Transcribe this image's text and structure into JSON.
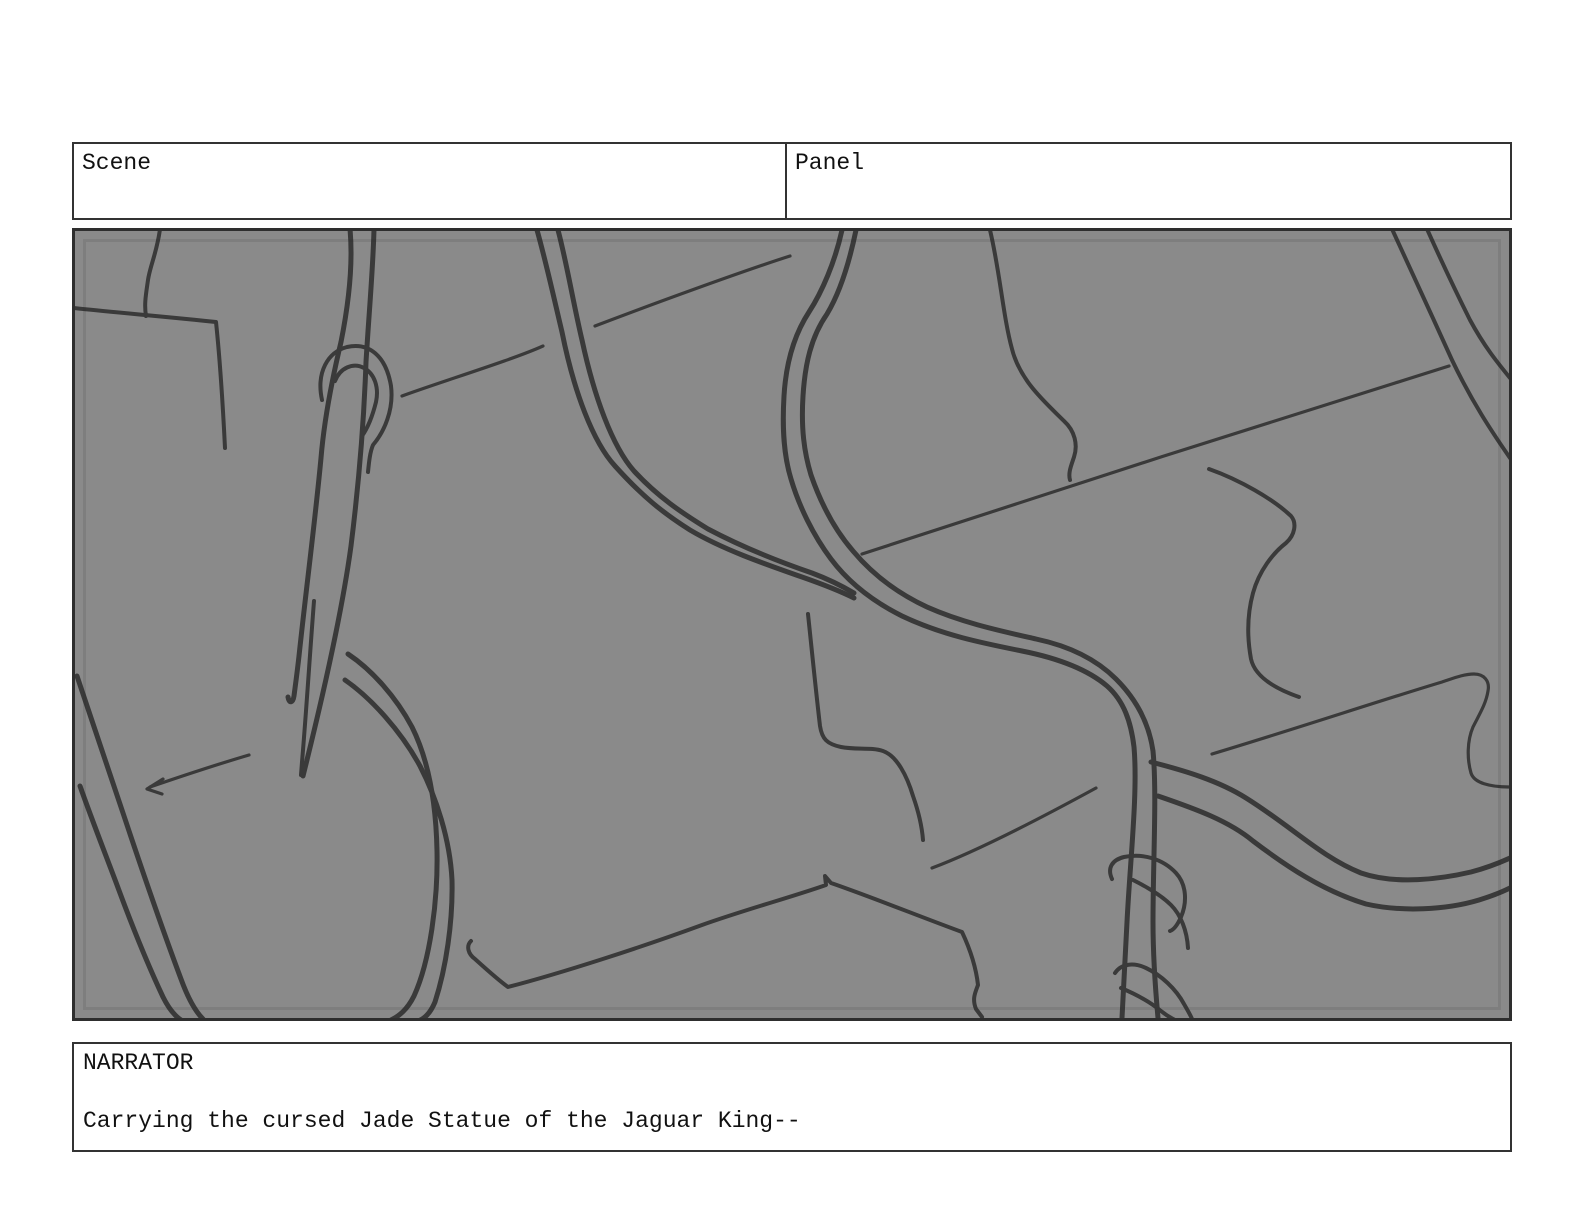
{
  "header": {
    "scene_label": "Scene",
    "panel_label": "Panel"
  },
  "dialog": {
    "speaker": "NARRATOR",
    "line": "Carrying the cursed Jade Statue of the Jaguar King--"
  },
  "storyboard_panel": {
    "background_color": "#8a8a8a",
    "stroke_color": "#3a3a3a",
    "border_color": "#2e2e2e",
    "description": "rough jungle-vine sketch",
    "strokes": [
      {
        "d": "M160,229 C157,252 150,266 148,280 C146,294 144,304 146,316",
        "w": 4
      },
      {
        "d": "M74,308 C110,312 170,317 216,322 C220,360 223,408 225,448",
        "w": 4
      },
      {
        "d": "M350,229 C353,262 349,302 341,342 C331,384 324,422 321,458 C315,522 306,590 299,656 C297,674 295,688 294,696 C293,703 289,704 288,697",
        "w": 5
      },
      {
        "d": "M374,229 C373,270 369,312 366,362 C364,420 359,482 351,546 C342,612 322,700 303,776",
        "w": 5
      },
      {
        "d": "M314,601 C310,652 306,716 302,762 L301,775",
        "w": 4
      },
      {
        "d": "M322,400 C316,372 328,352 347,347 C369,342 386,356 391,386 C394,410 384,432 373,445 C370,452 369,462 368,472",
        "w": 4
      },
      {
        "d": "M335,381 C340,368 353,362 364,368 C375,374 379,388 376,402 C372,418 367,429 362,436",
        "w": 4
      },
      {
        "d": "M537,230 C546,262 553,294 562,332 C574,392 593,442 615,466 C642,496 663,513 690,530 C722,549 762,563 802,577 C822,584 840,591 854,598",
        "w": 5
      },
      {
        "d": "M558,230 C567,264 573,302 582,340 C594,396 612,446 634,471 C658,497 682,513 708,529 C742,547 777,561 812,573 C828,579 842,586 854,593",
        "w": 5
      },
      {
        "d": "M842,230 C835,262 822,292 809,312 C794,335 786,362 784,396 C782,430 784,456 791,479 C799,506 813,535 831,559 C849,583 872,601 902,616 C942,635 982,643 1022,651 C1057,658 1087,669 1107,686 C1124,701 1131,722 1134,747 C1138,792 1130,862 1127,922 C1125,962 1123,996 1122,1018",
        "w": 5
      },
      {
        "d": "M856,230 C849,264 839,294 827,314 C811,337 805,364 803,396 C801,428 804,452 811,475 C820,501 834,529 853,551 C873,575 897,593 927,607 C963,623 1001,631 1036,639 C1069,646 1096,659 1116,679 C1136,699 1149,723 1153,751 C1157,792 1153,862 1153,922 C1153,962 1156,996 1158,1018",
        "w": 5
      },
      {
        "d": "M1151,762 C1186,771 1219,781 1246,798 C1291,826 1321,857 1361,873 C1396,885 1441,879 1471,872 C1486,868 1499,863 1510,858",
        "w": 5
      },
      {
        "d": "M1158,796 C1196,809 1229,821 1253,841 C1286,866 1323,891 1366,904 C1401,912 1446,910 1479,900 C1492,896 1502,892 1510,888",
        "w": 5
      },
      {
        "d": "M808,614 C812,652 816,692 820,726 C822,739 827,744 841,747 C856,750 871,747 883,751 C897,756 907,776 913,796 C919,813 922,827 923,840",
        "w": 4
      },
      {
        "d": "M595,326 C650,305 740,272 790,256",
        "w": 3.2
      },
      {
        "d": "M402,396 C440,382 512,360 543,346",
        "w": 3.2
      },
      {
        "d": "M862,554 C1000,508 1300,412 1449,366",
        "w": 3.2
      },
      {
        "d": "M990,230 C1000,272 1003,316 1012,349 C1020,381 1046,403 1064,421 C1075,431 1078,445 1074,457 C1071,466 1068,473 1070,480",
        "w": 4
      },
      {
        "d": "M1392,229 C1410,268 1432,316 1452,360 C1472,402 1492,432 1510,458",
        "w": 4
      },
      {
        "d": "M1427,229 C1440,258 1456,292 1470,320 C1484,346 1497,362 1510,378",
        "w": 4
      },
      {
        "d": "M1209,469 C1240,480 1273,499 1291,516 C1297,523 1295,535 1286,543 C1273,553 1259,571 1253,593 C1247,615 1247,637 1251,659 C1255,677 1276,689 1299,697",
        "w": 4
      },
      {
        "d": "M932,868 C980,850 1052,812 1096,788",
        "w": 3.2
      },
      {
        "d": "M1212,754 C1292,730 1382,700 1442,682 C1454,678 1464,674 1474,674 C1484,674 1490,681 1488,691 C1486,704 1479,715 1473,727 C1467,741 1467,759 1471,773 C1474,783 1490,787 1510,787",
        "w": 3.2
      },
      {
        "d": "M471,941 C466,946 468,954 475,959 C485,968 497,979 508,987 C562,973 642,947 702,925 C747,909 792,897 826,885 L825,876 L831,883 C869,896 921,917 962,932 C970,949 976,967 978,985 C975,993 972,999 976,1009 L982,1017",
        "w": 4
      },
      {
        "d": "M348,654 C372,670 396,697 412,727 C428,759 436,801 437,851 C438,901 430,961 414,996 C407,1010 399,1016 391,1020",
        "w": 5
      },
      {
        "d": "M345,680 C371,698 401,731 420,766 C436,797 450,839 452,880 C453,922 446,968 435,1002 C430,1014 424,1019 418,1021",
        "w": 5
      },
      {
        "d": "M77,676 C92,721 109,771 123,813 C141,867 163,931 181,979 C189,1001 196,1012 203,1019",
        "w": 5
      },
      {
        "d": "M80,786 C92,820 105,853 117,885 C131,923 147,963 163,997 C169,1009 175,1016 181,1020",
        "w": 5
      },
      {
        "d": "M249,755 C215,765 182,776 150,787",
        "w": 3.2
      },
      {
        "d": "M163,779 L147,789 L162,794",
        "w": 3.2
      },
      {
        "d": "M1112,879 C1107,868 1112,860 1124,857 C1143,853 1163,859 1176,873 C1187,885 1187,903 1181,917 C1177,926 1173,930 1170,931",
        "w": 4
      },
      {
        "d": "M1133,880 C1147,887 1161,895 1171,905 C1181,915 1187,931 1188,948",
        "w": 4
      },
      {
        "d": "M1115,973 C1121,964 1133,962 1146,968 C1161,975 1176,989 1184,1004 C1188,1011 1191,1016 1192,1019",
        "w": 4
      },
      {
        "d": "M1121,988 C1133,993 1149,1001 1161,1011 C1166,1015 1171,1018 1175,1020",
        "w": 4
      }
    ]
  }
}
